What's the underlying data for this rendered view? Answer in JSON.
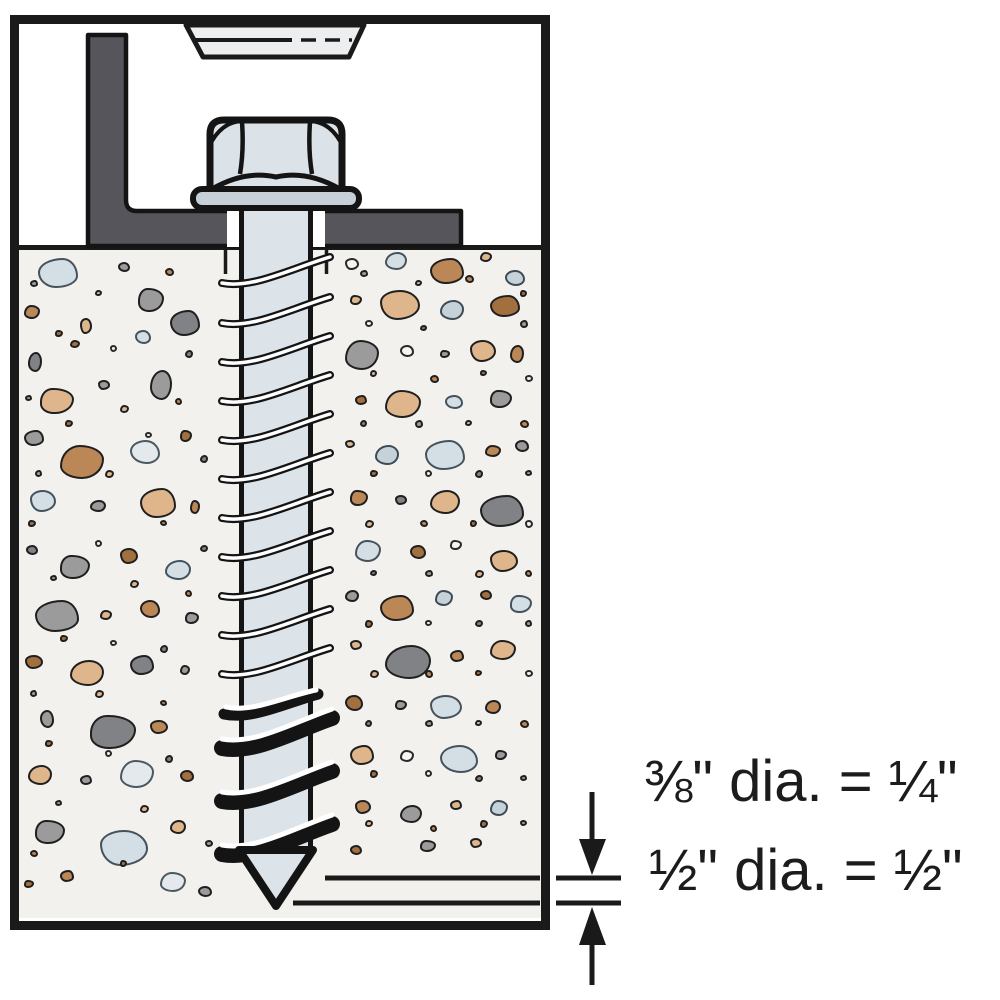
{
  "labels": {
    "upper": "⅜\" dia. = ¼\"",
    "lower": "½\" dia. = ½\""
  },
  "colors": {
    "outline": "#1a1a1a",
    "steel_shaft": "#dce4ea",
    "steel_head": "#dbe3e9",
    "steel_washer": "#c7d0d7",
    "fixture_head": "#eceeef",
    "bracket_gray": "#56555b",
    "concrete": "#f2f1ee"
  },
  "concrete": {
    "palette": [
      {
        "f": "#d4dee5",
        "s": "#44525c"
      },
      {
        "f": "#c6d2da",
        "s": "#3d4b55"
      },
      {
        "f": "#9b9b9b",
        "s": "#1f1f1f"
      },
      {
        "f": "#808285",
        "s": "#1f1f1f"
      },
      {
        "f": "#dfb68c",
        "s": "#1f1f1f"
      },
      {
        "f": "#bc8757",
        "s": "#1f1f1f"
      },
      {
        "f": "#a26f3f",
        "s": "#1f1f1f"
      },
      {
        "f": "#f6f5f3",
        "s": "#2a2a2a"
      },
      {
        "f": "#e3e9ed",
        "s": "#4a5860"
      }
    ],
    "shapes": [
      "62% 38% 55% 45% / 48% 60% 40% 52%",
      "45% 55% 50% 50% / 62% 42% 58% 38%",
      "52% 48% 44% 56% / 46% 58% 42% 54%",
      "38% 62% 58% 42% / 55% 45% 60% 40%",
      "50% 50% 58% 42% / 40% 52% 48% 60%",
      "57% 43% 46% 54% / 58% 46% 54% 42%"
    ],
    "stones": [
      [
        38,
        258,
        40,
        30,
        0,
        0
      ],
      [
        24,
        305,
        16,
        14,
        5,
        1
      ],
      [
        118,
        262,
        12,
        10,
        2,
        2
      ],
      [
        138,
        288,
        26,
        24,
        2,
        3
      ],
      [
        80,
        318,
        12,
        16,
        4,
        4
      ],
      [
        28,
        352,
        14,
        20,
        3,
        5
      ],
      [
        70,
        340,
        10,
        8,
        6,
        1
      ],
      [
        135,
        330,
        16,
        14,
        0,
        2
      ],
      [
        170,
        310,
        30,
        26,
        3,
        0
      ],
      [
        40,
        388,
        34,
        26,
        4,
        3
      ],
      [
        98,
        380,
        12,
        10,
        2,
        4
      ],
      [
        150,
        370,
        22,
        30,
        2,
        5
      ],
      [
        24,
        430,
        20,
        16,
        2,
        0
      ],
      [
        60,
        445,
        44,
        34,
        5,
        1
      ],
      [
        130,
        440,
        30,
        24,
        8,
        2
      ],
      [
        180,
        430,
        12,
        12,
        6,
        3
      ],
      [
        30,
        490,
        26,
        22,
        0,
        4
      ],
      [
        90,
        500,
        16,
        12,
        2,
        5
      ],
      [
        140,
        488,
        36,
        30,
        4,
        0
      ],
      [
        190,
        500,
        10,
        14,
        5,
        1
      ],
      [
        26,
        545,
        12,
        10,
        3,
        2
      ],
      [
        60,
        555,
        30,
        24,
        2,
        3
      ],
      [
        120,
        548,
        18,
        16,
        6,
        4
      ],
      [
        165,
        560,
        26,
        20,
        0,
        5
      ],
      [
        35,
        600,
        44,
        32,
        2,
        0
      ],
      [
        100,
        610,
        12,
        10,
        4,
        1
      ],
      [
        140,
        600,
        20,
        18,
        5,
        2
      ],
      [
        185,
        612,
        14,
        12,
        2,
        3
      ],
      [
        25,
        655,
        18,
        14,
        6,
        4
      ],
      [
        70,
        660,
        34,
        26,
        4,
        5
      ],
      [
        130,
        655,
        24,
        20,
        3,
        0
      ],
      [
        180,
        665,
        10,
        10,
        2,
        1
      ],
      [
        40,
        710,
        14,
        18,
        2,
        2
      ],
      [
        90,
        715,
        46,
        34,
        3,
        3
      ],
      [
        150,
        720,
        18,
        14,
        5,
        4
      ],
      [
        28,
        765,
        24,
        20,
        4,
        5
      ],
      [
        80,
        775,
        12,
        10,
        2,
        0
      ],
      [
        120,
        760,
        34,
        28,
        8,
        1
      ],
      [
        180,
        770,
        14,
        12,
        6,
        2
      ],
      [
        35,
        820,
        30,
        24,
        2,
        3
      ],
      [
        100,
        830,
        48,
        36,
        0,
        4
      ],
      [
        170,
        820,
        16,
        14,
        4,
        5
      ],
      [
        60,
        870,
        14,
        12,
        5,
        0
      ],
      [
        160,
        872,
        26,
        20,
        8,
        1
      ],
      [
        198,
        886,
        14,
        11,
        2,
        2
      ],
      [
        24,
        880,
        10,
        8,
        6,
        3
      ],
      [
        345,
        258,
        14,
        12,
        7,
        4
      ],
      [
        385,
        252,
        22,
        18,
        0,
        5
      ],
      [
        430,
        258,
        34,
        26,
        5,
        0
      ],
      [
        480,
        252,
        12,
        10,
        4,
        1
      ],
      [
        505,
        270,
        20,
        16,
        1,
        2
      ],
      [
        350,
        295,
        12,
        10,
        4,
        3
      ],
      [
        380,
        290,
        40,
        30,
        4,
        4
      ],
      [
        440,
        300,
        24,
        20,
        1,
        5
      ],
      [
        490,
        295,
        30,
        22,
        6,
        0
      ],
      [
        345,
        340,
        34,
        30,
        2,
        1
      ],
      [
        400,
        345,
        14,
        12,
        7,
        2
      ],
      [
        440,
        350,
        10,
        8,
        2,
        3
      ],
      [
        470,
        340,
        26,
        22,
        4,
        4
      ],
      [
        510,
        345,
        14,
        18,
        5,
        5
      ],
      [
        355,
        395,
        12,
        10,
        6,
        0
      ],
      [
        385,
        390,
        36,
        28,
        4,
        1
      ],
      [
        445,
        395,
        18,
        14,
        0,
        2
      ],
      [
        490,
        390,
        22,
        18,
        2,
        3
      ],
      [
        345,
        440,
        10,
        8,
        4,
        4
      ],
      [
        375,
        445,
        24,
        20,
        1,
        5
      ],
      [
        425,
        440,
        40,
        30,
        0,
        0
      ],
      [
        485,
        445,
        16,
        12,
        5,
        1
      ],
      [
        515,
        440,
        14,
        12,
        2,
        2
      ],
      [
        350,
        490,
        18,
        16,
        5,
        3
      ],
      [
        395,
        495,
        12,
        10,
        3,
        4
      ],
      [
        430,
        490,
        30,
        24,
        4,
        5
      ],
      [
        480,
        495,
        44,
        32,
        3,
        0
      ],
      [
        355,
        540,
        26,
        22,
        0,
        1
      ],
      [
        410,
        545,
        16,
        14,
        6,
        2
      ],
      [
        450,
        540,
        12,
        10,
        7,
        3
      ],
      [
        490,
        550,
        28,
        22,
        4,
        4
      ],
      [
        345,
        590,
        14,
        12,
        2,
        5
      ],
      [
        380,
        595,
        34,
        26,
        5,
        0
      ],
      [
        435,
        590,
        18,
        16,
        1,
        1
      ],
      [
        480,
        590,
        12,
        10,
        6,
        2
      ],
      [
        510,
        595,
        22,
        18,
        0,
        3
      ],
      [
        350,
        640,
        12,
        10,
        4,
        4
      ],
      [
        385,
        645,
        46,
        34,
        3,
        5
      ],
      [
        450,
        650,
        14,
        12,
        5,
        0
      ],
      [
        490,
        640,
        26,
        20,
        4,
        1
      ],
      [
        345,
        695,
        18,
        16,
        6,
        2
      ],
      [
        395,
        700,
        12,
        10,
        2,
        3
      ],
      [
        430,
        695,
        32,
        24,
        0,
        4
      ],
      [
        485,
        700,
        16,
        14,
        5,
        5
      ],
      [
        350,
        745,
        24,
        20,
        4,
        0
      ],
      [
        400,
        750,
        14,
        12,
        7,
        1
      ],
      [
        440,
        745,
        38,
        28,
        0,
        2
      ],
      [
        495,
        750,
        12,
        10,
        2,
        3
      ],
      [
        355,
        800,
        16,
        14,
        5,
        4
      ],
      [
        400,
        805,
        22,
        18,
        2,
        5
      ],
      [
        450,
        800,
        12,
        10,
        4,
        0
      ],
      [
        490,
        800,
        18,
        16,
        1,
        1
      ],
      [
        350,
        845,
        12,
        10,
        6,
        2
      ],
      [
        420,
        840,
        16,
        12,
        2,
        3
      ],
      [
        470,
        838,
        12,
        10,
        4,
        4
      ],
      [
        30,
        280,
        8,
        7,
        2,
        0
      ],
      [
        95,
        290,
        7,
        6,
        4,
        1
      ],
      [
        165,
        268,
        9,
        8,
        5,
        2
      ],
      [
        55,
        330,
        8,
        7,
        6,
        3
      ],
      [
        110,
        345,
        7,
        7,
        7,
        4
      ],
      [
        185,
        350,
        8,
        8,
        3,
        5
      ],
      [
        25,
        395,
        7,
        6,
        2,
        0
      ],
      [
        120,
        405,
        9,
        8,
        4,
        1
      ],
      [
        175,
        398,
        7,
        7,
        5,
        2
      ],
      [
        65,
        420,
        8,
        7,
        6,
        3
      ],
      [
        145,
        432,
        7,
        6,
        7,
        4
      ],
      [
        200,
        455,
        8,
        8,
        3,
        5
      ],
      [
        35,
        470,
        7,
        7,
        2,
        0
      ],
      [
        105,
        470,
        9,
        8,
        4,
        1
      ],
      [
        160,
        520,
        7,
        6,
        5,
        2
      ],
      [
        28,
        520,
        8,
        7,
        6,
        3
      ],
      [
        95,
        540,
        7,
        7,
        7,
        4
      ],
      [
        200,
        545,
        8,
        7,
        3,
        5
      ],
      [
        50,
        575,
        7,
        6,
        2,
        0
      ],
      [
        130,
        580,
        9,
        8,
        4,
        1
      ],
      [
        185,
        590,
        7,
        7,
        5,
        2
      ],
      [
        60,
        635,
        8,
        7,
        6,
        3
      ],
      [
        110,
        640,
        7,
        6,
        7,
        4
      ],
      [
        160,
        645,
        8,
        8,
        3,
        5
      ],
      [
        30,
        690,
        7,
        7,
        2,
        0
      ],
      [
        95,
        690,
        9,
        8,
        4,
        1
      ],
      [
        160,
        700,
        7,
        6,
        5,
        2
      ],
      [
        45,
        740,
        8,
        7,
        6,
        3
      ],
      [
        105,
        750,
        7,
        7,
        7,
        4
      ],
      [
        165,
        755,
        8,
        8,
        3,
        5
      ],
      [
        55,
        800,
        7,
        6,
        2,
        0
      ],
      [
        140,
        805,
        9,
        8,
        4,
        1
      ],
      [
        30,
        850,
        8,
        7,
        5,
        2
      ],
      [
        120,
        860,
        7,
        7,
        6,
        3
      ],
      [
        205,
        840,
        8,
        7,
        2,
        4
      ],
      [
        360,
        270,
        8,
        7,
        2,
        0
      ],
      [
        415,
        280,
        7,
        6,
        4,
        1
      ],
      [
        465,
        275,
        9,
        8,
        5,
        2
      ],
      [
        520,
        290,
        7,
        7,
        6,
        3
      ],
      [
        365,
        320,
        8,
        7,
        7,
        4
      ],
      [
        420,
        325,
        7,
        6,
        3,
        5
      ],
      [
        520,
        320,
        8,
        8,
        2,
        0
      ],
      [
        370,
        370,
        7,
        7,
        4,
        1
      ],
      [
        430,
        375,
        9,
        8,
        5,
        2
      ],
      [
        480,
        370,
        7,
        6,
        6,
        3
      ],
      [
        525,
        375,
        8,
        7,
        7,
        4
      ],
      [
        360,
        420,
        7,
        7,
        3,
        5
      ],
      [
        415,
        420,
        8,
        8,
        2,
        0
      ],
      [
        465,
        420,
        7,
        6,
        4,
        1
      ],
      [
        520,
        420,
        9,
        8,
        5,
        2
      ],
      [
        370,
        470,
        8,
        7,
        6,
        3
      ],
      [
        425,
        470,
        7,
        7,
        7,
        4
      ],
      [
        475,
        470,
        8,
        8,
        3,
        5
      ],
      [
        525,
        470,
        7,
        6,
        2,
        0
      ],
      [
        365,
        520,
        9,
        8,
        4,
        1
      ],
      [
        420,
        520,
        8,
        7,
        5,
        2
      ],
      [
        470,
        520,
        7,
        7,
        6,
        3
      ],
      [
        525,
        520,
        8,
        8,
        7,
        4
      ],
      [
        370,
        570,
        7,
        6,
        3,
        5
      ],
      [
        425,
        570,
        8,
        7,
        2,
        0
      ],
      [
        475,
        570,
        9,
        8,
        4,
        1
      ],
      [
        525,
        570,
        7,
        7,
        5,
        2
      ],
      [
        365,
        620,
        8,
        8,
        6,
        3
      ],
      [
        425,
        620,
        7,
        6,
        7,
        4
      ],
      [
        475,
        620,
        8,
        7,
        3,
        5
      ],
      [
        525,
        620,
        7,
        7,
        2,
        0
      ],
      [
        370,
        670,
        9,
        8,
        4,
        1
      ],
      [
        425,
        670,
        8,
        8,
        5,
        2
      ],
      [
        475,
        670,
        7,
        6,
        6,
        3
      ],
      [
        525,
        670,
        8,
        7,
        7,
        4
      ],
      [
        365,
        720,
        7,
        7,
        3,
        5
      ],
      [
        425,
        720,
        8,
        7,
        2,
        0
      ],
      [
        475,
        720,
        7,
        6,
        4,
        1
      ],
      [
        520,
        720,
        9,
        8,
        5,
        2
      ],
      [
        370,
        770,
        8,
        8,
        6,
        3
      ],
      [
        425,
        770,
        7,
        7,
        7,
        4
      ],
      [
        475,
        775,
        8,
        7,
        3,
        5
      ],
      [
        520,
        775,
        7,
        6,
        2,
        0
      ],
      [
        365,
        820,
        8,
        7,
        4,
        1
      ],
      [
        430,
        825,
        7,
        7,
        5,
        2
      ],
      [
        480,
        820,
        8,
        8,
        6,
        3
      ],
      [
        520,
        820,
        7,
        6,
        2,
        4
      ]
    ]
  }
}
